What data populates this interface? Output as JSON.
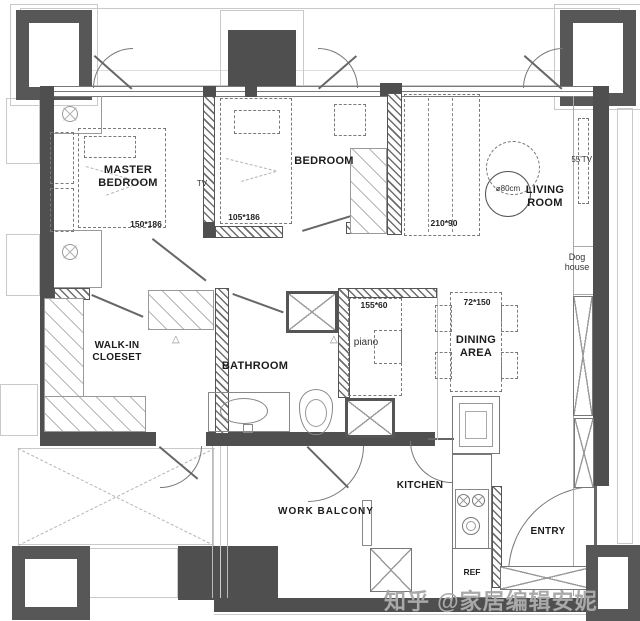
{
  "watermark": {
    "text": "知乎 @家居编辑安妮"
  },
  "markers": {
    "threshold": "△"
  },
  "rooms": {
    "master_bedroom": {
      "name_line1": "MASTER",
      "name_line2": "BEDROOM",
      "bed_dim": "150*186"
    },
    "bedroom": {
      "name": "BEDROOM",
      "bed_dim": "105*186",
      "tv_label": "TV"
    },
    "living_room": {
      "name_line1": "LIVING",
      "name_line2": "ROOM",
      "coffee_table_diameter": "⌀80cm",
      "tv_label": "55'TV",
      "sofa_dim": "210*90"
    },
    "dog_house": {
      "line1": "Dog",
      "line2": "house"
    },
    "walk_in_closet": {
      "name_line1": "WALK-IN",
      "name_line2": "CLOESET"
    },
    "bathroom": {
      "name": "BATHROOM"
    },
    "piano_nook": {
      "label": "piano",
      "dim": "155*60"
    },
    "dining_area": {
      "name_line1": "DINING",
      "name_line2": "AREA",
      "table_dim": "72*150"
    },
    "kitchen": {
      "name": "KITCHEN",
      "fridge_label": "REF"
    },
    "work_balcony": {
      "name": "WORK BALCONY"
    },
    "entry": {
      "name": "ENTRY"
    }
  }
}
